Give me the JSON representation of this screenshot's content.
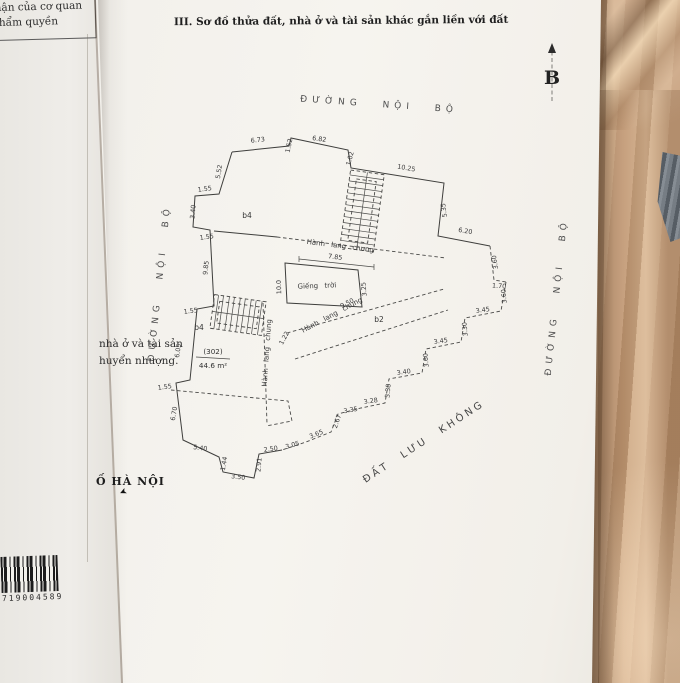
{
  "colors": {
    "paper": "#f4f2ee",
    "fabric": "#bf9877",
    "ink": "#3b3b3b",
    "road_text": "#4f4f4f"
  },
  "icons": {
    "north_arrow": "▲",
    "city_arrow": "➤"
  },
  "document": {
    "stamp_box": {
      "line1": "c nhận của cơ quan",
      "line2": "có thẩm quyền"
    },
    "section_title": "III. Sơ đồ thửa đất, nhà ở và tài sản khác gắn liền với đất",
    "north_label": "B",
    "road_top": "ĐƯỜNG NỘI BỘ",
    "road_left": "ĐƯỜNG NỘI BỘ",
    "road_right": "ĐƯỜNG NỘI BỘ",
    "buffer_land_label": "ĐẤT LƯU KHÔNG",
    "side_note": {
      "line1": "nhà ở và tài sản",
      "line2": "huyển nhượng."
    },
    "city_note": "Ố HÀ NỘI",
    "barcode_number": "719004589"
  },
  "diagram": {
    "unit_number": "(302)",
    "unit_area": "44.6 m²",
    "lightwell": "Giếng trời",
    "blocks": [
      {
        "text": "b4",
        "x": 247,
        "y": 218,
        "rot": 0
      },
      {
        "text": "b4",
        "x": 199,
        "y": 330,
        "rot": 0
      },
      {
        "text": "b2",
        "x": 379,
        "y": 322,
        "rot": 0
      }
    ],
    "corridors": [
      {
        "text": "Hành lang chung",
        "x": 340,
        "y": 248,
        "rot": 7
      },
      {
        "text": "Hành lang chung",
        "x": 333,
        "y": 317,
        "rot": -28
      },
      {
        "text": "Hành lang chung",
        "x": 269,
        "y": 353,
        "rot": -86
      }
    ],
    "dims": [
      {
        "text": "6.73",
        "x": 258,
        "y": 142,
        "rot": -6
      },
      {
        "text": "1.52",
        "x": 291,
        "y": 146,
        "rot": -78
      },
      {
        "text": "6.82",
        "x": 319,
        "y": 141,
        "rot": 8
      },
      {
        "text": "1.02",
        "x": 352,
        "y": 159,
        "rot": -75
      },
      {
        "text": "10.25",
        "x": 406,
        "y": 170,
        "rot": 10
      },
      {
        "text": "5.35",
        "x": 446,
        "y": 210,
        "rot": -98
      },
      {
        "text": "6.20",
        "x": 465,
        "y": 233,
        "rot": 9
      },
      {
        "text": "3.60",
        "x": 497,
        "y": 262,
        "rot": -99
      },
      {
        "text": "1.70",
        "x": 499,
        "y": 288,
        "rot": 4
      },
      {
        "text": "5.52",
        "x": 221,
        "y": 172,
        "rot": -81
      },
      {
        "text": "1.55",
        "x": 205,
        "y": 191,
        "rot": -8
      },
      {
        "text": "3.40",
        "x": 195,
        "y": 212,
        "rot": -85
      },
      {
        "text": "1.55",
        "x": 207,
        "y": 239,
        "rot": -8
      },
      {
        "text": "9.85",
        "x": 208,
        "y": 268,
        "rot": -84
      },
      {
        "text": "1.55",
        "x": 191,
        "y": 313,
        "rot": -8
      },
      {
        "text": "6.05",
        "x": 180,
        "y": 351,
        "rot": -82
      },
      {
        "text": "1.55",
        "x": 165,
        "y": 389,
        "rot": -8
      },
      {
        "text": "6.70",
        "x": 176,
        "y": 414,
        "rot": -80
      },
      {
        "text": "5.40",
        "x": 200,
        "y": 450,
        "rot": 8
      },
      {
        "text": "1.44",
        "x": 226,
        "y": 464,
        "rot": -80
      },
      {
        "text": "3.50",
        "x": 238,
        "y": 479,
        "rot": 7
      },
      {
        "text": "2.91",
        "x": 261,
        "y": 465,
        "rot": -85
      },
      {
        "text": "2.50",
        "x": 271,
        "y": 451,
        "rot": -8
      },
      {
        "text": "3.05",
        "x": 293,
        "y": 447,
        "rot": -16
      },
      {
        "text": "3.65",
        "x": 317,
        "y": 436,
        "rot": -22
      },
      {
        "text": "2.67",
        "x": 339,
        "y": 422,
        "rot": -72
      },
      {
        "text": "3.35",
        "x": 351,
        "y": 412,
        "rot": -10
      },
      {
        "text": "3.28",
        "x": 371,
        "y": 403,
        "rot": -8
      },
      {
        "text": "3.38",
        "x": 390,
        "y": 391,
        "rot": -85
      },
      {
        "text": "3.40",
        "x": 404,
        "y": 374,
        "rot": -8
      },
      {
        "text": "3.60",
        "x": 428,
        "y": 360,
        "rot": -95
      },
      {
        "text": "3.45",
        "x": 441,
        "y": 343,
        "rot": -8
      },
      {
        "text": "3.30",
        "x": 467,
        "y": 329,
        "rot": -95
      },
      {
        "text": "3.45",
        "x": 483,
        "y": 312,
        "rot": -8
      },
      {
        "text": "3.60",
        "x": 506,
        "y": 296,
        "rot": -95
      },
      {
        "text": "7.85",
        "x": 335,
        "y": 259,
        "rot": 7
      },
      {
        "text": "3.25",
        "x": 366,
        "y": 289,
        "rot": -95
      },
      {
        "text": "10.0",
        "x": 281,
        "y": 287,
        "rot": -92
      },
      {
        "text": "9.50",
        "x": 348,
        "y": 305,
        "rot": -27
      },
      {
        "text": "1.22",
        "x": 286,
        "y": 339,
        "rot": -62
      }
    ]
  }
}
